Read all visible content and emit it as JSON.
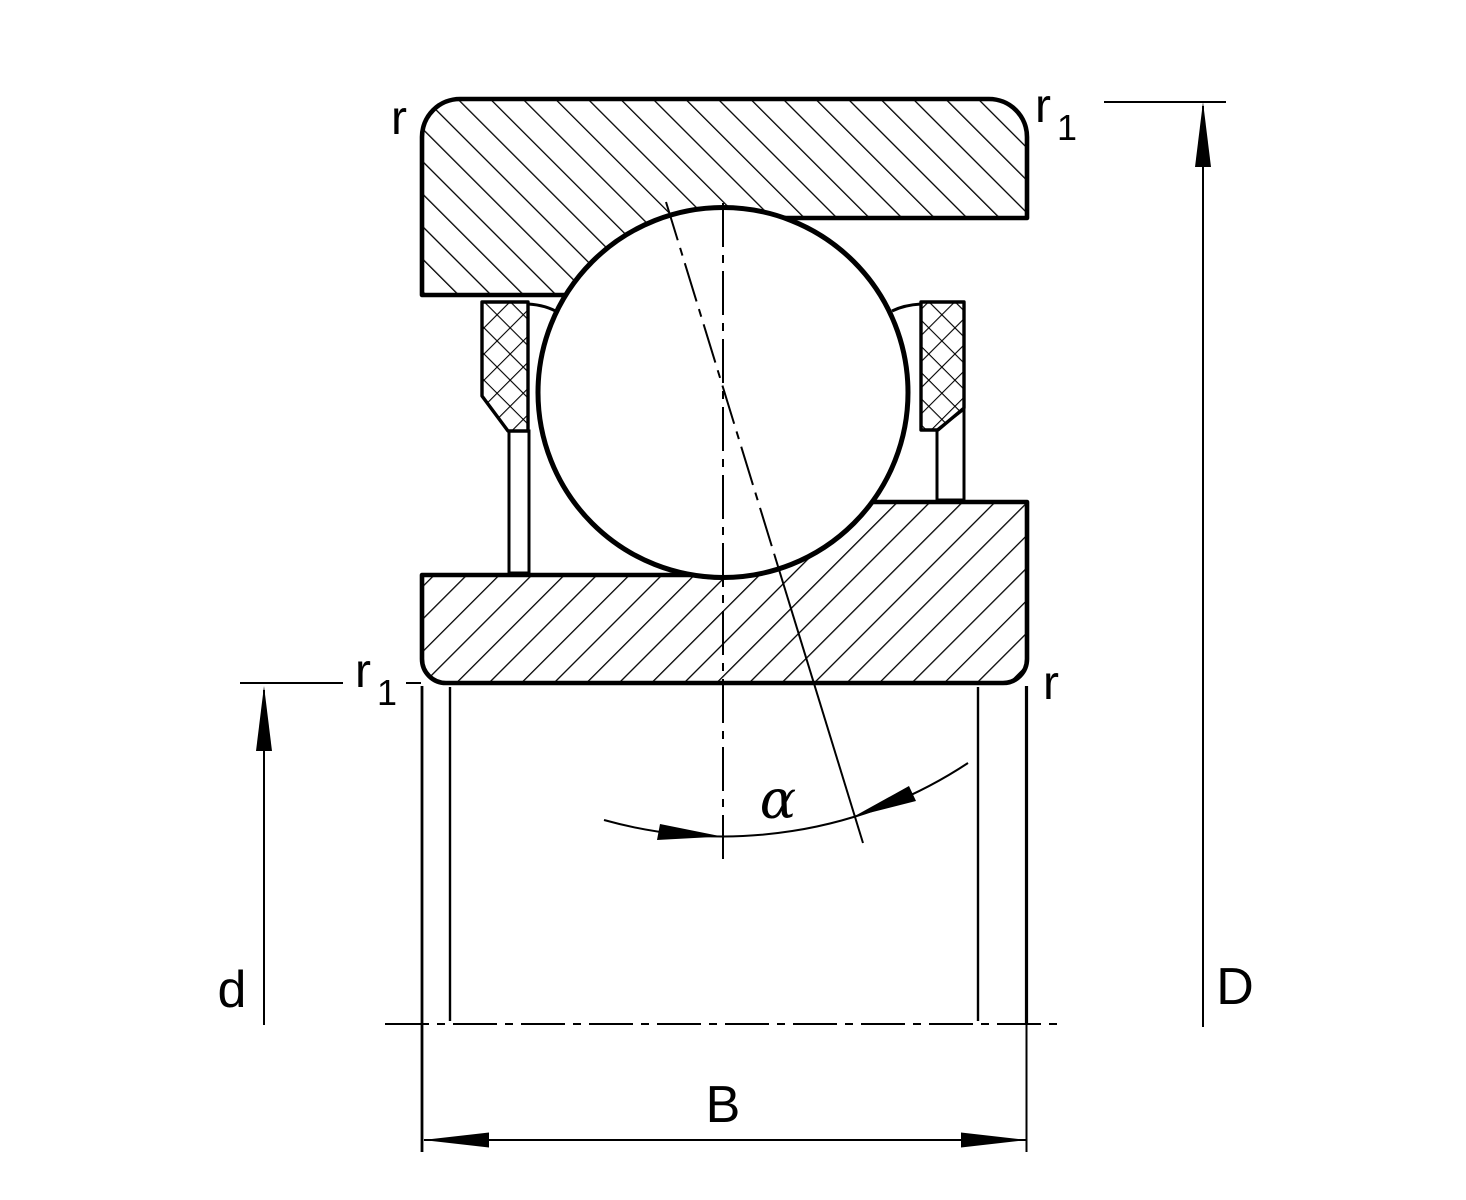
{
  "figure": {
    "kind": "angular-contact-ball-bearing-cross-section",
    "colors": {
      "line": "#000000",
      "background": "#ffffff"
    },
    "labels": {
      "radius_top_left": "r",
      "radius_top_right_base": "r",
      "radius_top_right_sub": "1",
      "radius_mid_left_base": "r",
      "radius_mid_left_sub": "1",
      "radius_mid_right": "r",
      "bore_diameter": "d",
      "outer_diameter": "D",
      "width": "B",
      "contact_angle": "α"
    }
  }
}
